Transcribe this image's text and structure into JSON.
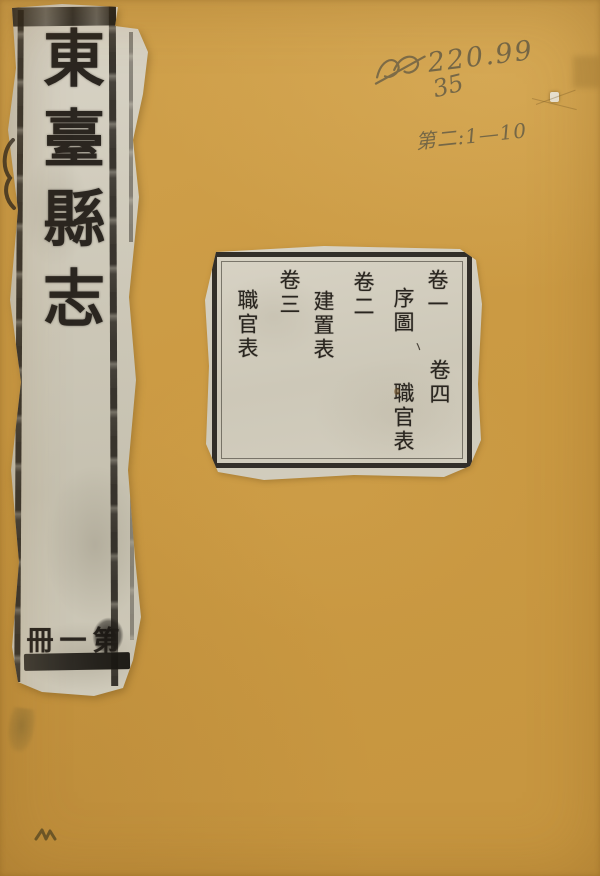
{
  "cover": {
    "spine_label": {
      "title": "東臺縣志",
      "fascicle": "第一冊"
    },
    "contents_label": {
      "entries": [
        {
          "volume": "卷一",
          "title": "序圖"
        },
        {
          "volume": "卷四",
          "title": "職官表"
        },
        {
          "volume": "卷二",
          "title": "建置表"
        },
        {
          "volume": "卷三",
          "title": "職官表"
        }
      ]
    },
    "handwritten": {
      "call_number": "220.99",
      "shelf_number": "35",
      "volume_note": "第二:1—10"
    },
    "decorations": {
      "ink_tick": "ヽ"
    },
    "colors": {
      "cover_ochre": "#cb9a43",
      "label_paper": "#d5d0c2",
      "ink": "#26221c",
      "pencil": "#685e45"
    }
  }
}
